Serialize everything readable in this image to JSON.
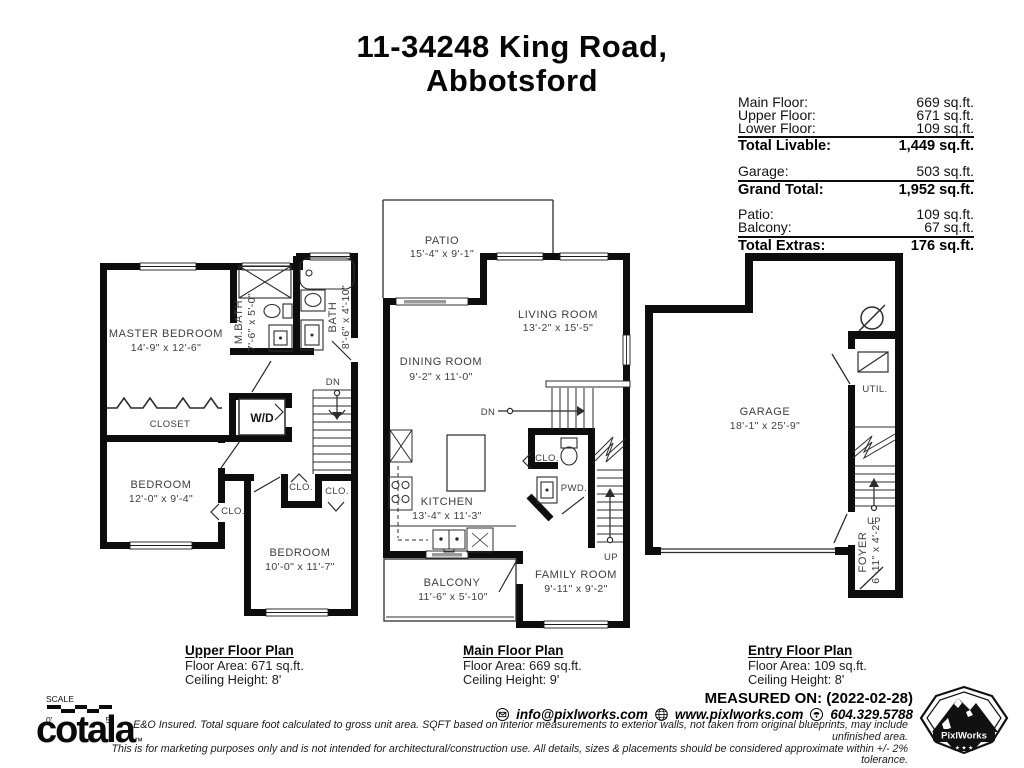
{
  "title": {
    "line1": "11-34248 King Road,",
    "line2": "Abbotsford"
  },
  "area_summary": {
    "groups": [
      {
        "rows": [
          {
            "label": "Main Floor:",
            "value": "669 sq.ft."
          },
          {
            "label": "Upper Floor:",
            "value": "671 sq.ft."
          },
          {
            "label": "Lower Floor:",
            "value": "109 sq.ft."
          }
        ],
        "total": {
          "label": "Total Livable:",
          "value": "1,449 sq.ft."
        }
      },
      {
        "rows": [
          {
            "label": "Garage:",
            "value": "503 sq.ft."
          }
        ],
        "total": {
          "label": "Grand Total:",
          "value": "1,952 sq.ft."
        }
      },
      {
        "rows": [
          {
            "label": "Patio:",
            "value": "109 sq.ft."
          },
          {
            "label": "Balcony:",
            "value": "67 sq.ft."
          }
        ],
        "total": {
          "label": "Total Extras:",
          "value": "176 sq.ft."
        }
      }
    ]
  },
  "plans": {
    "upper": {
      "labels": {
        "master_bedroom": {
          "name": "MASTER BEDROOM",
          "dims": "14'-9\" x 12'-6\""
        },
        "mbath": {
          "name": "M.BATH",
          "dims": "7'-6\" x 5'-0\""
        },
        "bath": {
          "name": "BATH",
          "dims": "8'-6\" x 4'-10\""
        },
        "closet": "CLOSET",
        "wd": "W/D",
        "dn": "DN",
        "clo": "CLO.",
        "bedroom1": {
          "name": "BEDROOM",
          "dims": "12'-0\" x 9'-4\""
        },
        "bedroom2": {
          "name": "BEDROOM",
          "dims": "10'-0\" x 11'-7\""
        }
      },
      "caption": {
        "title": "Upper Floor Plan",
        "area": "Floor Area: 671 sq.ft.",
        "ceiling": "Ceiling Height: 8'"
      }
    },
    "main": {
      "labels": {
        "patio": {
          "name": "PATIO",
          "dims": "15'-4\" x 9'-1\""
        },
        "living": {
          "name": "LIVING ROOM",
          "dims": "13'-2\" x 15'-5\""
        },
        "dining": {
          "name": "DINING ROOM",
          "dims": "9'-2\" x 11'-0\""
        },
        "kitchen": {
          "name": "KITCHEN",
          "dims": "13'-4\" x 11'-3\""
        },
        "family": {
          "name": "FAMILY ROOM",
          "dims": "9'-11\" x 9'-2\""
        },
        "balcony": {
          "name": "BALCONY",
          "dims": "11'-6\" x 5'-10\""
        },
        "clo": "CLO.",
        "pwd": "PWD.",
        "dn": "DN",
        "up": "UP"
      },
      "caption": {
        "title": "Main Floor Plan",
        "area": "Floor Area: 669 sq.ft.",
        "ceiling": "Ceiling Height: 9'"
      }
    },
    "entry": {
      "labels": {
        "garage": {
          "name": "GARAGE",
          "dims": "18'-1\" x 25'-9\""
        },
        "util": "UTIL.",
        "foyer": {
          "name": "FOYER",
          "dims": "6'-11\" x 4'-2\""
        },
        "up": "UP"
      },
      "caption": {
        "title": "Entry Floor Plan",
        "area": "Floor Area: 109 sq.ft.",
        "ceiling": "Ceiling Height: 8'"
      }
    }
  },
  "footer": {
    "scale": {
      "label": "SCALE",
      "start": "0'",
      "end": "5'"
    },
    "brand": {
      "name": "cotala",
      "tm": "™"
    },
    "measured_on": "MEASURED ON: (2022-02-28)",
    "contacts": {
      "email": "info@pixlworks.com",
      "website": "www.pixlworks.com",
      "phone": "604.329.5788"
    },
    "disclaimer_line1": "E&O Insured.  Total square foot calculated to gross unit area. SQFT based on interior measurements to exterior walls, not taken from original blueprints, may include unfinished area.",
    "disclaimer_line2": "This is for marketing purposes only and is not intended for architectural/construction use.  All details, sizes & placements should be considered approximate within +/- 2%  tolerance.",
    "logo": {
      "text": "PixlWorks",
      "stars": "★ ★ ★"
    }
  }
}
